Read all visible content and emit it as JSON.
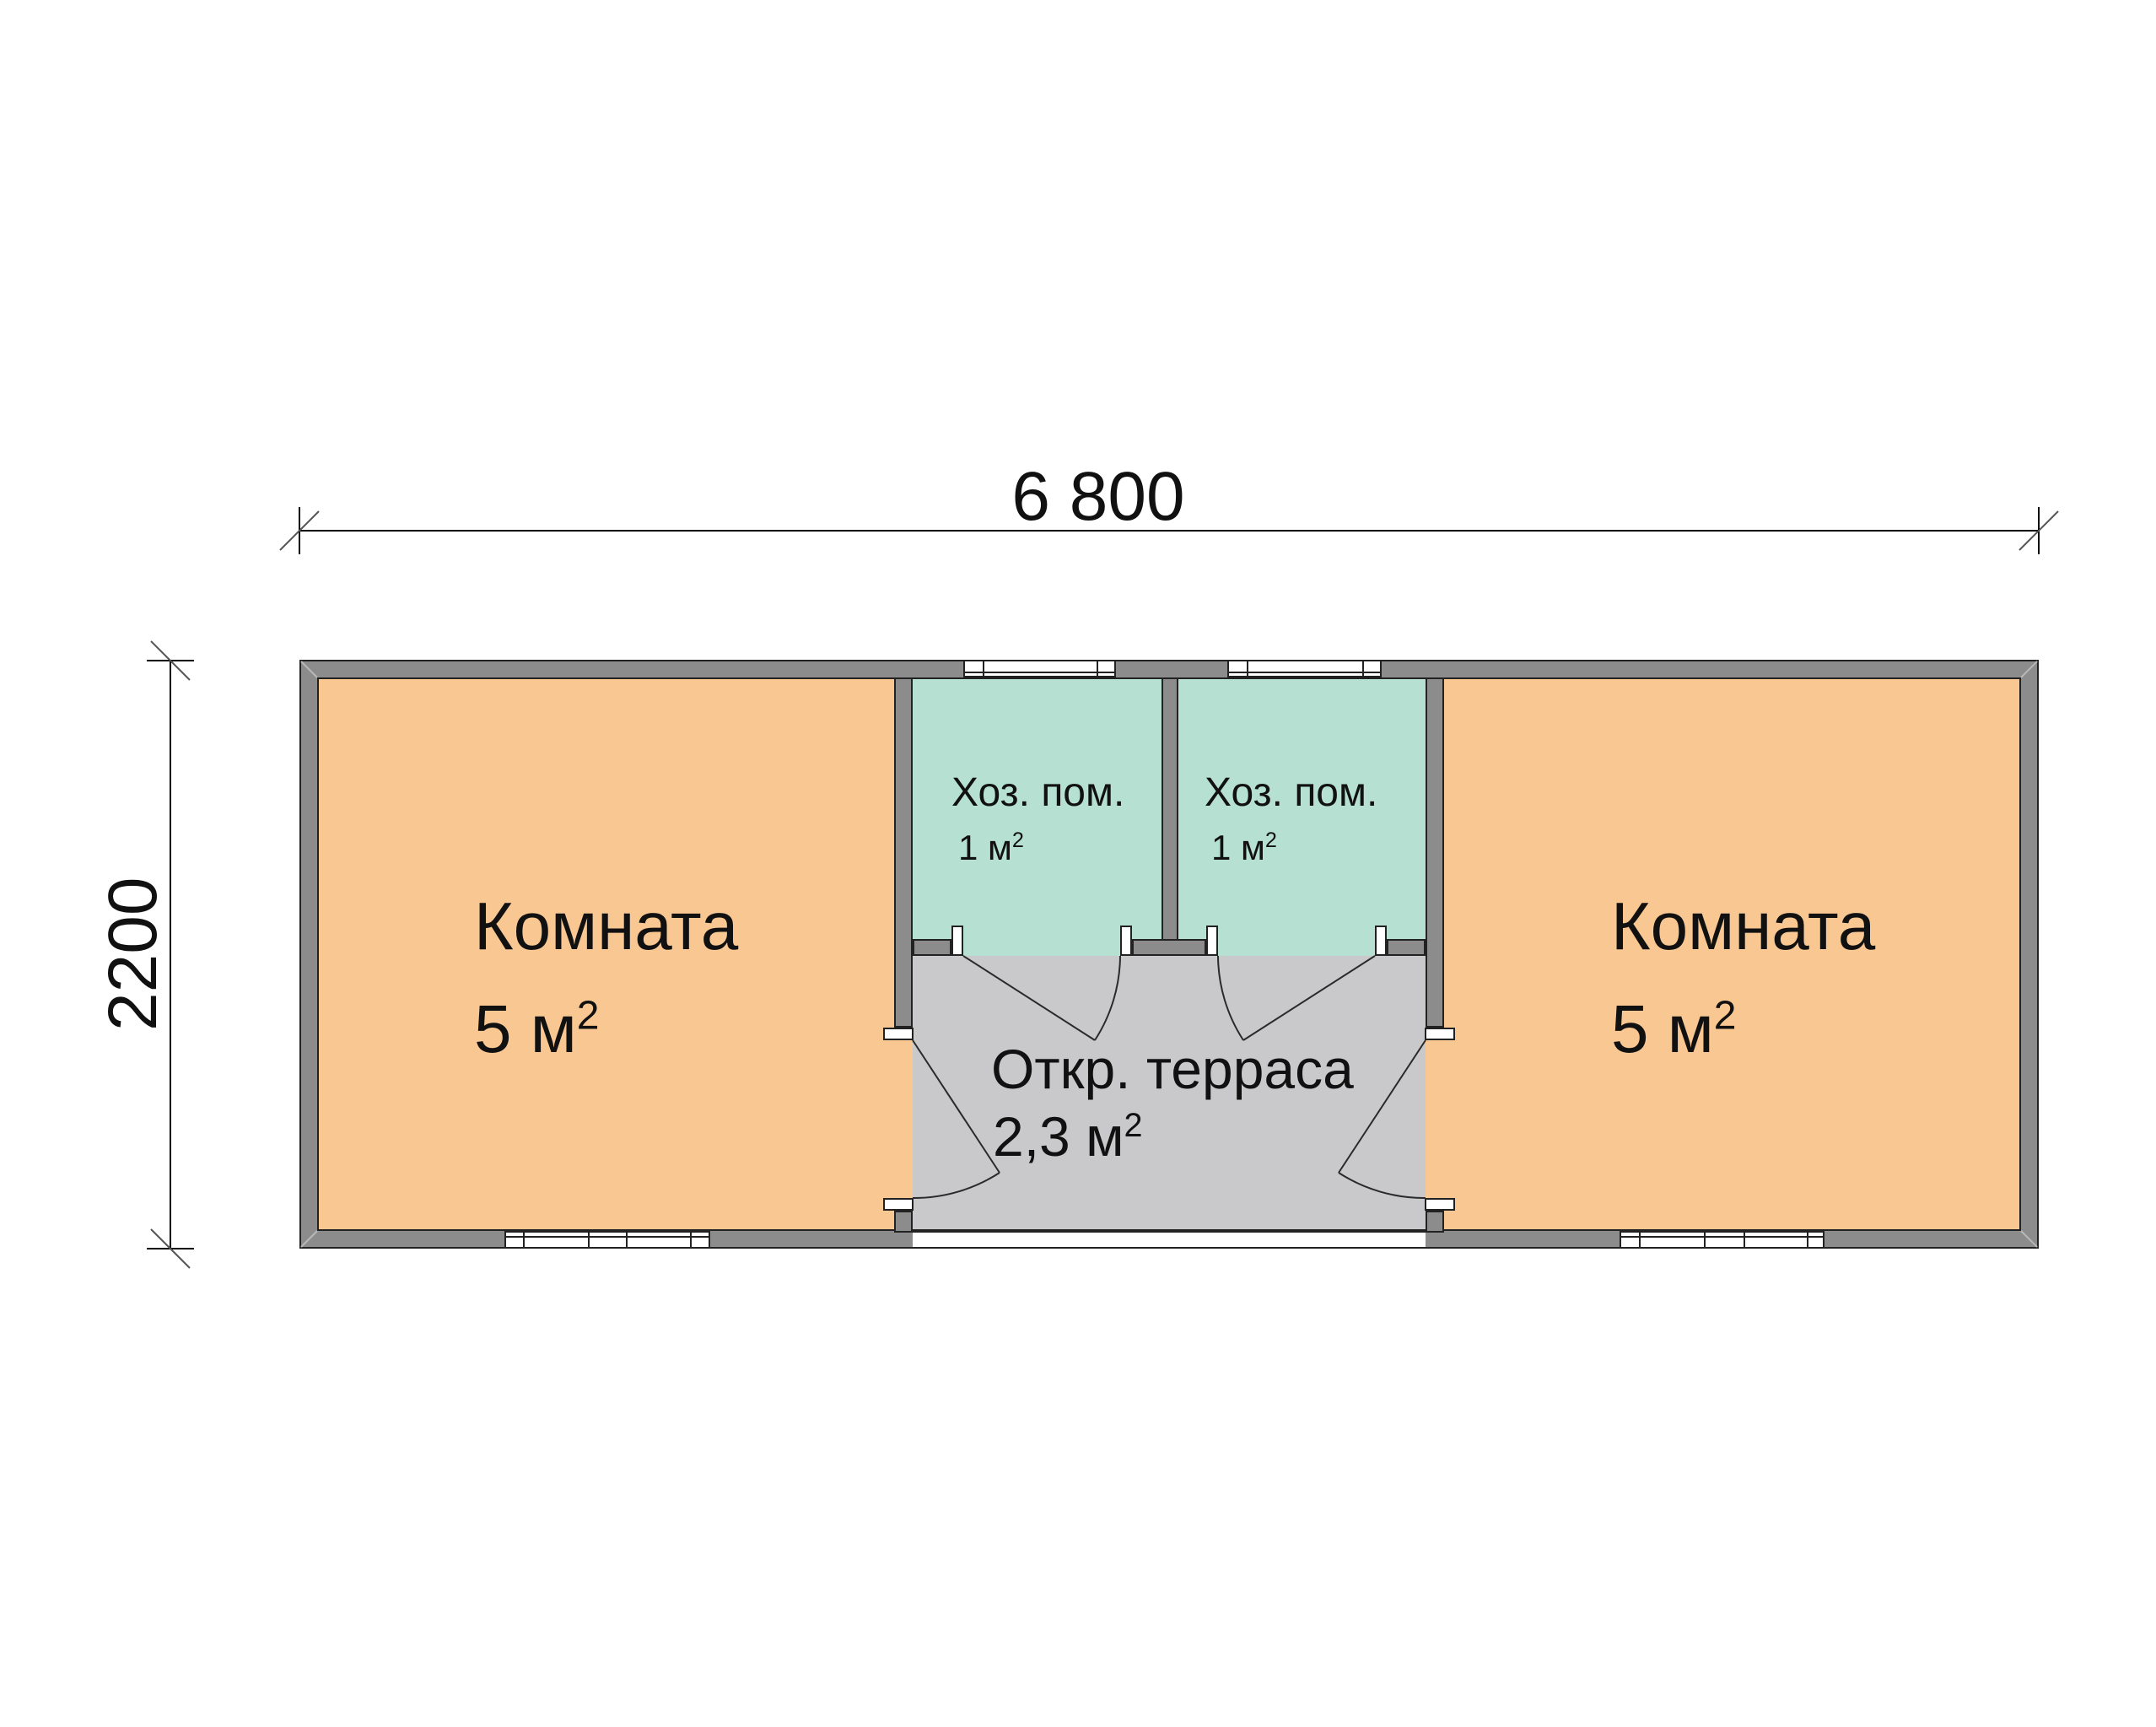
{
  "dimensions": {
    "width": "6 800",
    "height": "2200"
  },
  "rooms": {
    "room_left": {
      "name": "Комната",
      "area_base": "5 м",
      "area_sup": "2"
    },
    "room_right": {
      "name": "Комната",
      "area_base": "5 м",
      "area_sup": "2"
    },
    "utility_left": {
      "name": "Хоз. пом.",
      "area_base": "1 м",
      "area_sup": "2"
    },
    "utility_right": {
      "name": "Хоз. пом.",
      "area_base": "1 м",
      "area_sup": "2"
    },
    "terrace": {
      "name": "Откр. терраса",
      "area_base": "2,3 м",
      "area_sup": "2"
    }
  },
  "colors": {
    "room_fill": "#F9C791",
    "utility_fill": "#B6E0D2",
    "terrace_fill": "#C9C9CB",
    "wall_fill": "#8C8C8C",
    "outline": "#222222"
  }
}
